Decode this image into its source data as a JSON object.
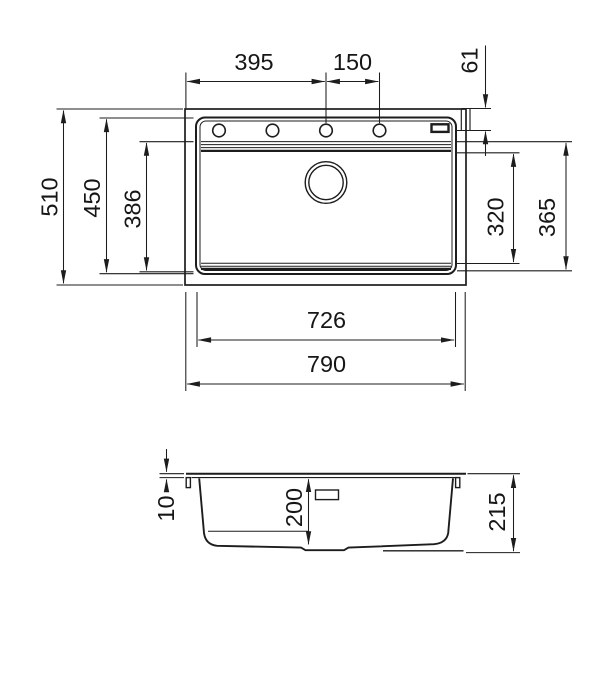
{
  "colors": {
    "line": "#1d1d1d",
    "background": "#ffffff"
  },
  "dims": {
    "d395": "395",
    "d150": "150",
    "d61": "61",
    "d510": "510",
    "d450": "450",
    "d386": "386",
    "d320": "320",
    "d365": "365",
    "d726": "726",
    "d790": "790",
    "d10": "10",
    "d200": "200",
    "d215": "215"
  }
}
